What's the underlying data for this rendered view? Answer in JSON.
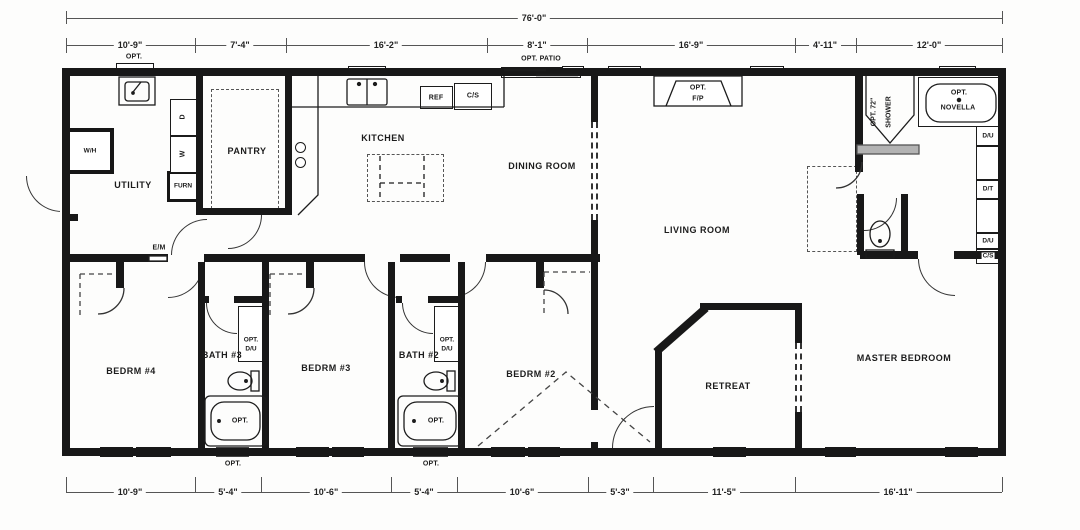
{
  "plan_type": "floor-plan",
  "dimensions": {
    "overall": "76'-0\"",
    "top": [
      "10'-9\"",
      "7'-4\"",
      "16'-2\"",
      "8'-1\"",
      "16'-9\"",
      "4'-11\"",
      "12'-0\""
    ],
    "bottom": [
      "10'-9\"",
      "5'-4\"",
      "10'-6\"",
      "5'-4\"",
      "10'-6\"",
      "5'-3\"",
      "11'-5\"",
      "16'-11\""
    ]
  },
  "rooms": {
    "utility": "UTILITY",
    "pantry": "PANTRY",
    "kitchen": "KITCHEN",
    "dining": "DINING ROOM",
    "living": "LIVING ROOM",
    "bedroom4": "BEDRM #4",
    "bath3": "BATH #3",
    "bedroom3": "BEDRM #3",
    "bath2": "BATH #2",
    "bedroom2": "BEDRM #2",
    "retreat": "RETREAT",
    "master": "MASTER BEDROOM"
  },
  "labels": {
    "opt_utility_window": "OPT.",
    "water_heater": "W/H",
    "dryer": "D",
    "washer": "W",
    "furnace": "FURN",
    "elec_meter": "E/M",
    "ref": "REF",
    "cs_kitchen": "C/S",
    "opt_patio": "OPT. PATIO",
    "opt_fp_1": "OPT.",
    "opt_fp_2": "F/P",
    "opt_shower_1": "OPT. 72\"",
    "opt_shower_2": "SHOWER",
    "opt_novella_1": "OPT.",
    "opt_novella_2": "NOVELLA",
    "du_upper": "D/U",
    "dt": "D/T",
    "du_lower": "D/U",
    "cs_master": "C/S",
    "bath3_sink_opt": "OPT.",
    "bath3_sink_du": "D/U",
    "bath2_sink_opt": "OPT.",
    "bath2_sink_du": "D/U",
    "bath3_tub_opt": "OPT.",
    "bath2_tub_opt": "OPT.",
    "bath3_window_opt": "OPT.",
    "bath2_window_opt": "OPT."
  },
  "colors": {
    "wall": "#181818",
    "line": "#333333",
    "optional_window_fill": "#c9c9c9",
    "shower_sill": "#b3b3b3",
    "background": "#fdfdfc"
  }
}
